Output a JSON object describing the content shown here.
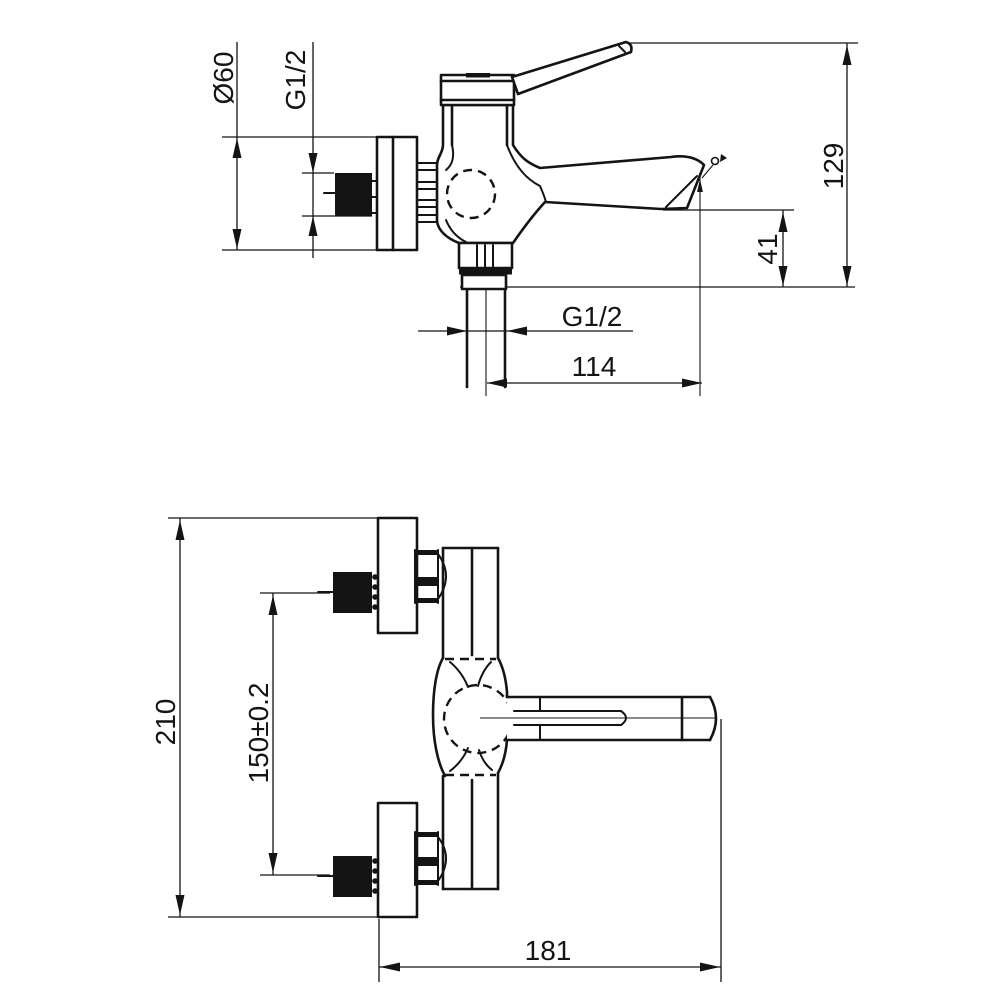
{
  "colors": {
    "background": "#ffffff",
    "line": "#141414"
  },
  "views": {
    "side": {
      "dims": {
        "flange_diameter": "Ø60",
        "wall_thread": "G1/2",
        "overall_height": "129",
        "spout_outlet_height": "41",
        "outlet_thread": "G1/2",
        "spout_reach": "114"
      }
    },
    "front": {
      "dims": {
        "overall_height": "210",
        "inlet_spacing": "150±0.2",
        "overall_depth": "181"
      }
    }
  }
}
